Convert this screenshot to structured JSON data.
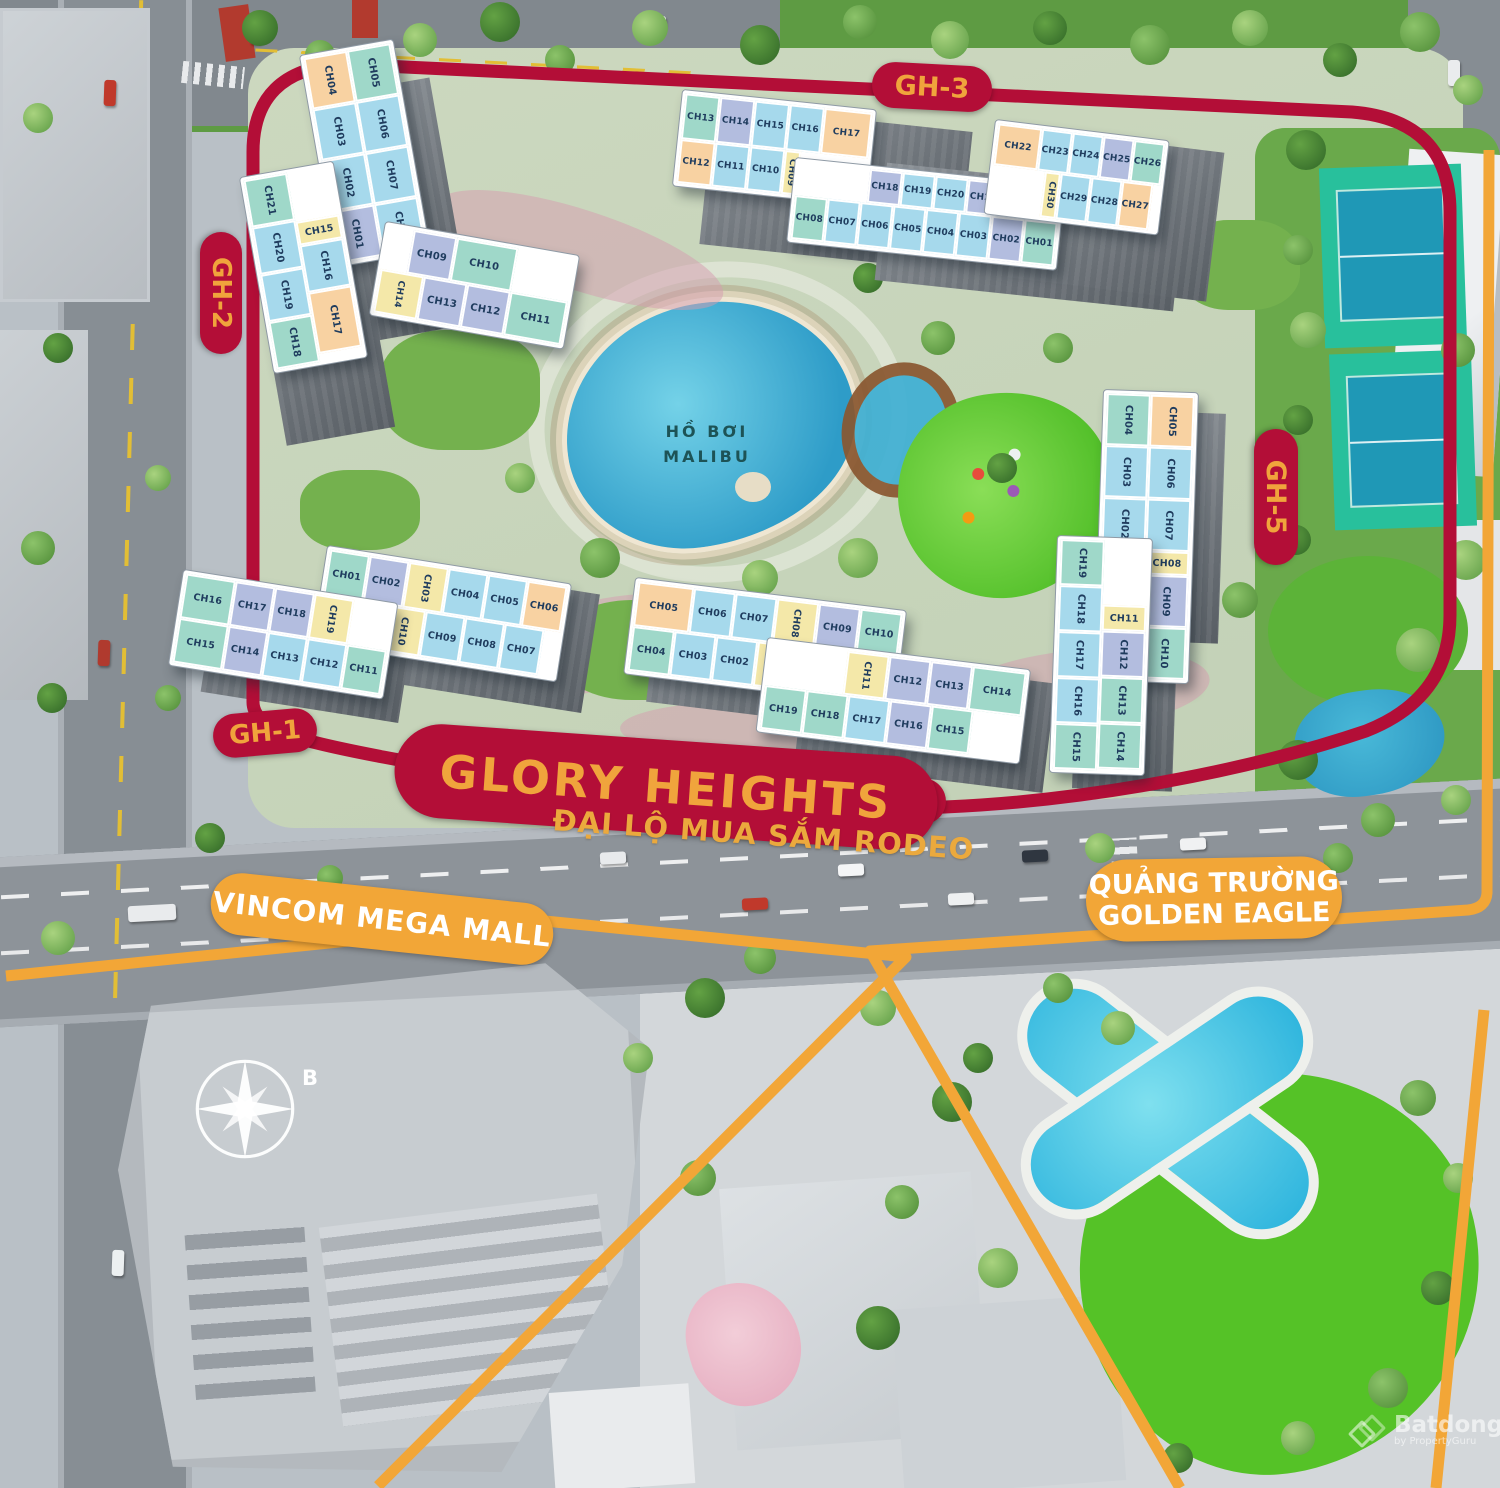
{
  "labels": {
    "glory": "GLORY HEIGHTS",
    "street": "ĐẠI LỘ MUA SẮM RODEO",
    "vincom": "VINCOM MEGA MALL",
    "square_line1": "QUẢNG TRƯỜNG",
    "square_line2": "GOLDEN EAGLE",
    "pool_line1": "HỒ BƠI",
    "pool_line2": "MALIBU",
    "compass": "B"
  },
  "pills": {
    "gh1": "GH-1",
    "gh2": "GH-2",
    "gh3": "GH-3",
    "gh5": "GH-5",
    "gh6": "GH-6"
  },
  "watermark": {
    "brand": "Batdongsan",
    "domain": ".com.vn",
    "byline": "by PropertyGuru"
  },
  "colors": {
    "boundary_red": "#b30e37",
    "boundary_orange": "#f2a637",
    "pill_text_gold": "#f0a43c",
    "unit_green": "#9fd8c9",
    "unit_blue": "#a6d9ec",
    "unit_purple": "#b3bddf",
    "unit_orange": "#f8d2a2",
    "unit_yellow": "#f4e8a9"
  },
  "buildings": {
    "gh2": {
      "a1": [
        {
          "t": "CH04",
          "c": "o"
        },
        {
          "t": "CH03",
          "c": "b"
        },
        {
          "t": "CH02",
          "c": "b"
        },
        {
          "t": "CH01",
          "c": "p"
        }
      ],
      "a2": [
        {
          "t": "CH05",
          "c": "g"
        },
        {
          "t": "CH06",
          "c": "b"
        },
        {
          "t": "CH07",
          "c": "b"
        },
        {
          "t": "CH08",
          "c": "b"
        }
      ],
      "b1": [
        {
          "t": "CH09",
          "c": "p"
        },
        {
          "t": "CH10",
          "c": "g"
        }
      ],
      "b2": [
        {
          "t": "CH14",
          "c": "y",
          "alt": true
        },
        {
          "t": "CH13",
          "c": "p"
        },
        {
          "t": "CH12",
          "c": "p"
        },
        {
          "t": "CH11",
          "c": "g"
        }
      ],
      "c1": [
        {
          "t": "CH21",
          "c": "g"
        },
        {
          "t": "CH20",
          "c": "b"
        },
        {
          "t": "CH19",
          "c": "b"
        },
        {
          "t": "CH18",
          "c": "g"
        }
      ],
      "c2": [
        {
          "t": "CH15",
          "c": "y",
          "alt": true
        },
        {
          "t": "CH16",
          "c": "b"
        },
        {
          "t": "CH17",
          "c": "o"
        }
      ]
    },
    "gh3": {
      "l1": [
        {
          "t": "CH13",
          "c": "g"
        },
        {
          "t": "CH14",
          "c": "p"
        },
        {
          "t": "CH15",
          "c": "b"
        },
        {
          "t": "CH16",
          "c": "b"
        },
        {
          "t": "CH17",
          "c": "o"
        }
      ],
      "l2": [
        {
          "t": "CH12",
          "c": "o"
        },
        {
          "t": "CH11",
          "c": "b"
        },
        {
          "t": "CH10",
          "c": "b"
        },
        {
          "t": "CH09",
          "c": "y",
          "alt": true
        }
      ],
      "m1": [
        {
          "t": "CH18",
          "c": "p"
        },
        {
          "t": "CH19",
          "c": "b"
        },
        {
          "t": "CH20",
          "c": "b"
        },
        {
          "t": "CH21",
          "c": "p"
        }
      ],
      "m2": [
        {
          "t": "CH08",
          "c": "g"
        },
        {
          "t": "CH07",
          "c": "b"
        },
        {
          "t": "CH06",
          "c": "b"
        },
        {
          "t": "CH05",
          "c": "b"
        },
        {
          "t": "CH04",
          "c": "b"
        },
        {
          "t": "CH03",
          "c": "b"
        },
        {
          "t": "CH02",
          "c": "p"
        },
        {
          "t": "CH01",
          "c": "g"
        }
      ],
      "r1": [
        {
          "t": "CH22",
          "c": "o"
        },
        {
          "t": "CH23",
          "c": "b"
        },
        {
          "t": "CH24",
          "c": "b"
        },
        {
          "t": "CH25",
          "c": "p"
        },
        {
          "t": "CH26",
          "c": "g"
        }
      ],
      "r2": [
        {
          "t": "CH30",
          "c": "y",
          "alt": true
        },
        {
          "t": "CH29",
          "c": "b"
        },
        {
          "t": "CH28",
          "c": "b"
        },
        {
          "t": "CH27",
          "c": "o"
        }
      ]
    },
    "gh5": {
      "t1": [
        {
          "t": "CH04",
          "c": "g"
        },
        {
          "t": "CH03",
          "c": "b"
        },
        {
          "t": "CH02",
          "c": "b"
        },
        {
          "t": "CH01",
          "c": "y",
          "alt": true
        }
      ],
      "t2": [
        {
          "t": "CH05",
          "c": "o"
        },
        {
          "t": "CH06",
          "c": "b"
        },
        {
          "t": "CH07",
          "c": "b"
        },
        {
          "t": "CH08",
          "c": "y",
          "alt": true
        },
        {
          "t": "CH09",
          "c": "p"
        },
        {
          "t": "CH10",
          "c": "g"
        }
      ],
      "b1": [
        {
          "t": "CH19",
          "c": "g"
        },
        {
          "t": "CH18",
          "c": "b"
        },
        {
          "t": "CH17",
          "c": "b"
        },
        {
          "t": "CH16",
          "c": "b"
        },
        {
          "t": "CH15",
          "c": "g"
        }
      ],
      "b2": [
        {
          "t": "CH11",
          "c": "y",
          "alt": true
        },
        {
          "t": "CH12",
          "c": "p"
        },
        {
          "t": "CH13",
          "c": "g"
        },
        {
          "t": "CH14",
          "c": "g"
        }
      ]
    },
    "gh1": {
      "r1": [
        {
          "t": "CH01",
          "c": "g"
        },
        {
          "t": "CH02",
          "c": "p"
        },
        {
          "t": "CH03",
          "c": "y",
          "alt": true
        },
        {
          "t": "CH04",
          "c": "b"
        },
        {
          "t": "CH05",
          "c": "b"
        },
        {
          "t": "CH06",
          "c": "o"
        }
      ],
      "r2": [
        {
          "t": "CH10",
          "c": "y",
          "alt": true
        },
        {
          "t": "CH09",
          "c": "b"
        },
        {
          "t": "CH08",
          "c": "b"
        },
        {
          "t": "CH07",
          "c": "b"
        }
      ],
      "l1": [
        {
          "t": "CH16",
          "c": "g"
        },
        {
          "t": "CH17",
          "c": "p"
        },
        {
          "t": "CH18",
          "c": "p"
        },
        {
          "t": "CH19",
          "c": "y",
          "alt": true
        }
      ],
      "l2": [
        {
          "t": "CH15",
          "c": "g"
        },
        {
          "t": "CH14",
          "c": "p"
        },
        {
          "t": "CH13",
          "c": "b"
        },
        {
          "t": "CH12",
          "c": "b"
        },
        {
          "t": "CH11",
          "c": "g"
        }
      ]
    },
    "gh6": {
      "u1": [
        {
          "t": "CH05",
          "c": "o"
        },
        {
          "t": "CH06",
          "c": "b"
        },
        {
          "t": "CH07",
          "c": "b"
        },
        {
          "t": "CH08",
          "c": "y",
          "alt": true
        },
        {
          "t": "CH09",
          "c": "p"
        },
        {
          "t": "CH10",
          "c": "g"
        }
      ],
      "u2": [
        {
          "t": "CH04",
          "c": "g"
        },
        {
          "t": "CH03",
          "c": "b"
        },
        {
          "t": "CH02",
          "c": "b"
        },
        {
          "t": "CH01",
          "c": "y",
          "alt": true
        }
      ],
      "l1": [
        {
          "t": "CH11",
          "c": "y",
          "alt": true
        },
        {
          "t": "CH12",
          "c": "p"
        },
        {
          "t": "CH13",
          "c": "p"
        },
        {
          "t": "CH14",
          "c": "g"
        }
      ],
      "l2": [
        {
          "t": "CH19",
          "c": "g"
        },
        {
          "t": "CH18",
          "c": "g"
        },
        {
          "t": "CH17",
          "c": "b"
        },
        {
          "t": "CH16",
          "c": "p"
        },
        {
          "t": "CH15",
          "c": "g"
        }
      ]
    }
  }
}
